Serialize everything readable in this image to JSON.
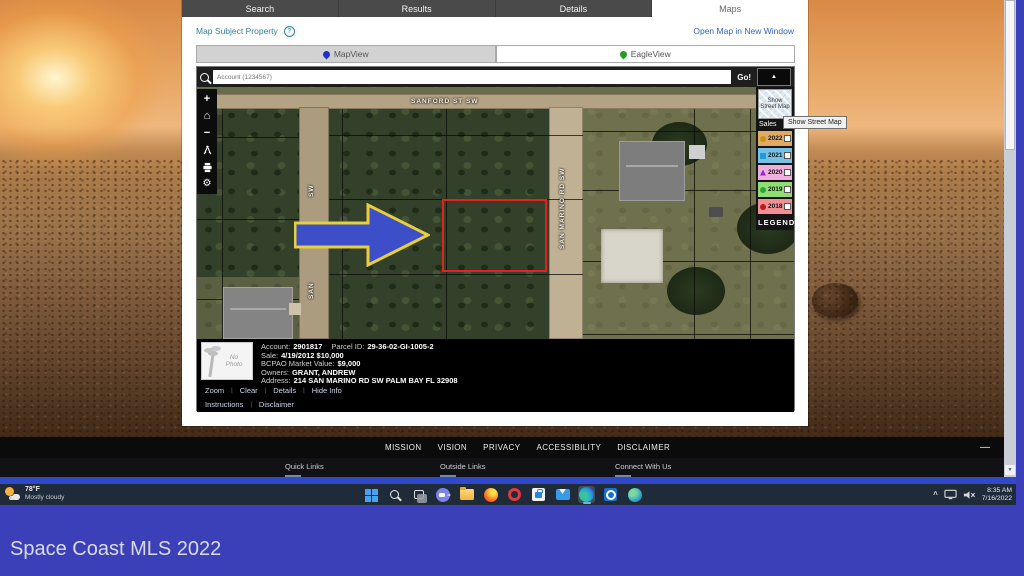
{
  "colors": {
    "canvas_blue": "#3b40b8",
    "taskbar_bg": "#202b3a",
    "link_blue": "#2f66c8",
    "teal": "#2e7fa3",
    "arrow_blue": "#3d4ec9",
    "arrow_outline": "#e8cf3e",
    "parcel_red": "#e4211c",
    "active_tab_underline": "#6fb2f0"
  },
  "icons": {
    "collapse_arrow": "▲",
    "help": "?",
    "zoom_in": "+",
    "zoom_out": "−",
    "home": "⌂",
    "gear": "⚙",
    "tray_chevron": "^",
    "scroll_down": "▼",
    "minimize": "—"
  },
  "browser": {
    "main_tabs": [
      {
        "label": "Search"
      },
      {
        "label": "Results"
      },
      {
        "label": "Details"
      },
      {
        "label": "Maps",
        "active": true
      }
    ],
    "subheader": {
      "left_link": "Map Subject Property",
      "right_link": "Open Map in New Window"
    },
    "view_tabs": [
      {
        "label": "MapView",
        "active": true
      },
      {
        "label": "EagleView"
      }
    ]
  },
  "map": {
    "search": {
      "placeholder": "Account (1234567)",
      "go": "Go!"
    },
    "streets": {
      "top": "SANFORD ST SW",
      "right": "SAN MARINO RD SW",
      "left_top_fragment": "SW",
      "left_bottom_fragment": "SAN"
    },
    "legend": {
      "street_map_button": "Show Street Map",
      "tooltip": "Show Street Map",
      "sales": "Sales",
      "footer": "LEGEND",
      "rows": [
        {
          "year": "2022",
          "bg": "#e2a964",
          "marker": "m-circle",
          "marker_color": "#c79114"
        },
        {
          "year": "2021",
          "bg": "#74c2e8",
          "marker": "m-square",
          "marker_color": "#1e9cd8"
        },
        {
          "year": "2020",
          "bg": "#f0aede",
          "marker": "m-triangle",
          "marker_color": "#8e2fd0"
        },
        {
          "year": "2019",
          "bg": "#90dd74",
          "marker": "m-circle",
          "marker_color": "#2da53c"
        },
        {
          "year": "2018",
          "bg": "#f09094",
          "marker": "m-circle",
          "marker_color": "#c01a1a"
        }
      ]
    },
    "info": {
      "no_photo": "No Photo",
      "rows": [
        {
          "label": "Account:",
          "value": "2901817",
          "label2": "Parcel ID:",
          "value2": "29-36-02-GI-1005-2"
        },
        {
          "label": "Sale:",
          "value": "4/19/2012 $10,000"
        },
        {
          "label": "BCPAO Market Value:",
          "value": "$9,000"
        },
        {
          "label": "Owners:",
          "value": "GRANT, ANDREW"
        },
        {
          "label": "Address:",
          "value": "214 SAN MARINO RD SW PALM BAY FL 32908"
        }
      ]
    },
    "links_row1": [
      "Zoom",
      "Clear",
      "Details",
      "Hide Info"
    ],
    "links_row2": [
      "Instructions",
      "Disclaimer"
    ]
  },
  "page_footer": {
    "nav": [
      "MISSION",
      "VISION",
      "PRIVACY",
      "ACCESSIBILITY",
      "DISCLAIMER"
    ],
    "columns": [
      "Quick Links",
      "Outside Links",
      "Connect With Us"
    ]
  },
  "taskbar": {
    "weather": {
      "temp": "78°F",
      "condition": "Mostly cloudy"
    },
    "icons": [
      "start",
      "search",
      "task-view",
      "chat",
      "file-explorer",
      "firefox",
      "opera",
      "store",
      "mail",
      "edge",
      "outlook",
      "globe"
    ],
    "tray": {
      "time": "8:35 AM",
      "date": "7/16/2022"
    }
  },
  "watermark": "Space Coast MLS 2022"
}
